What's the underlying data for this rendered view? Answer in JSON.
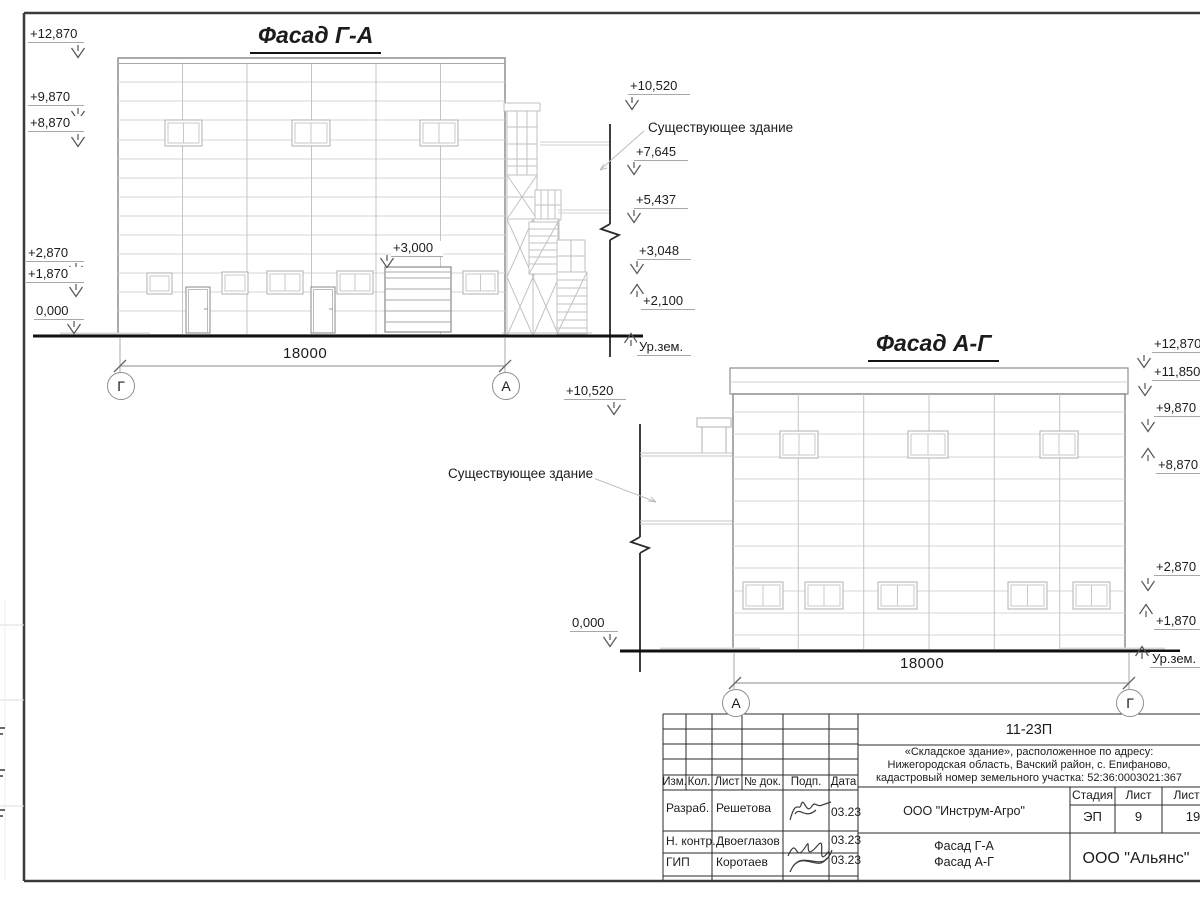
{
  "drawing": {
    "facade_ga": {
      "title": "Фасад Г-А",
      "dimension": "18000",
      "axis_left": "Г",
      "axis_right": "А",
      "gate_mark": "+3,000",
      "marks_left": [
        "+12,870",
        "+9,870",
        "+8,870",
        "+2,870",
        "+1,870",
        "0,000"
      ],
      "marks_right": [
        "+10,520",
        "+7,645",
        "+5,437",
        "+3,048",
        "+2,100"
      ],
      "existing_building_label": "Существующее здание",
      "ground_label": "Ур.зем."
    },
    "facade_ag": {
      "title": "Фасад А-Г",
      "dimension": "18000",
      "axis_left": "А",
      "axis_right": "Г",
      "marks_left": [
        "+10,520",
        "0,000"
      ],
      "marks_right": [
        "+12,870",
        "+11,850",
        "+9,870",
        "+8,870",
        "+2,870",
        "+1,870"
      ],
      "existing_building_label": "Существующее здание",
      "ground_label": "Ур.зем."
    }
  },
  "title_block": {
    "code": "11-23П",
    "project_lines": [
      "«Складское здание», расположенное по адресу:",
      "Нижегородская область, Вачский район, с. Епифаново,",
      "кадастровый номер земельного участка: 52:36:0003021:367"
    ],
    "header_cells": [
      "Изм.",
      "Кол.",
      "Лист",
      "№ док.",
      "Подп.",
      "Дата"
    ],
    "rows": [
      {
        "role": "Разраб.",
        "name": "Решетова",
        "date": "03.23"
      },
      {
        "role": "Н. контр.",
        "name": "Двоеглазов",
        "date": "03.23"
      },
      {
        "role": "ГИП",
        "name": "Коротаев",
        "date": "03.23"
      }
    ],
    "company": "ООО \"Инструм-Агро\"",
    "sheet_title_lines": [
      "Фасад Г-А",
      "Фасад А-Г"
    ],
    "stage_label": "Стадия",
    "sheet_label": "Лист",
    "sheets_label": "Листов",
    "stage": "ЭП",
    "sheet": "9",
    "sheets": "19",
    "org": "ООО \"Альянс\""
  }
}
